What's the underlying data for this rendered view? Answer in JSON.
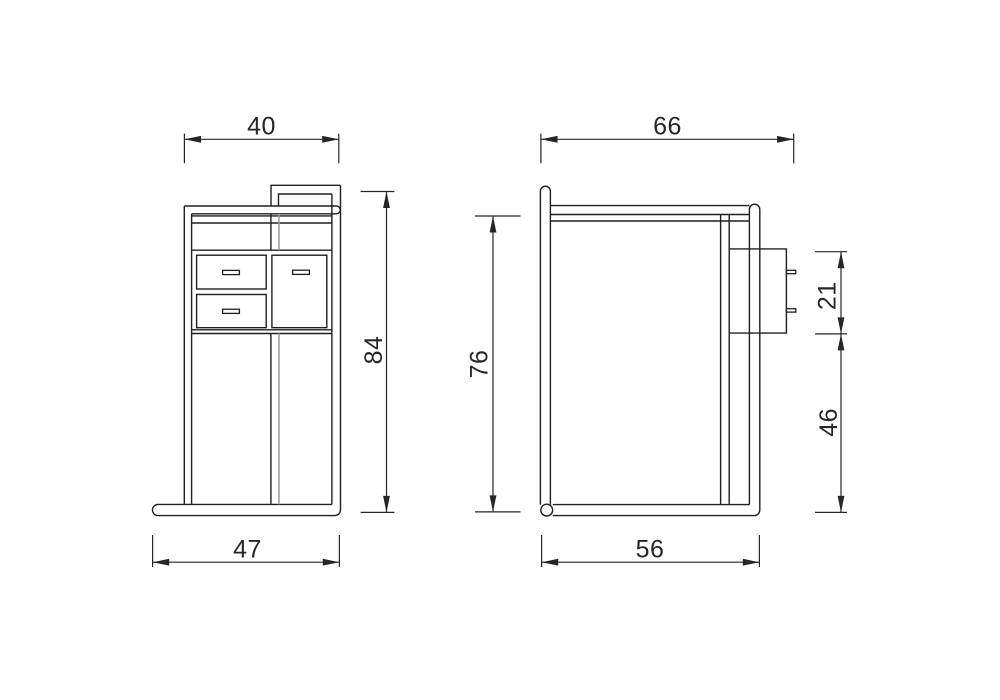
{
  "canvas": {
    "width": 1000,
    "height": 700,
    "background": "#ffffff"
  },
  "colors": {
    "line": "#1f1f1f",
    "hidden_line": "#9b9b9b",
    "dimension": "#262626"
  },
  "views": {
    "front": {
      "dims": {
        "top_width": "40",
        "overall_height": "84",
        "base_width": "47"
      }
    },
    "side": {
      "dims": {
        "top_depth": "66",
        "side_height": "76",
        "drawer_block_height": "21",
        "clearance_height": "46",
        "base_depth": "56"
      }
    }
  }
}
